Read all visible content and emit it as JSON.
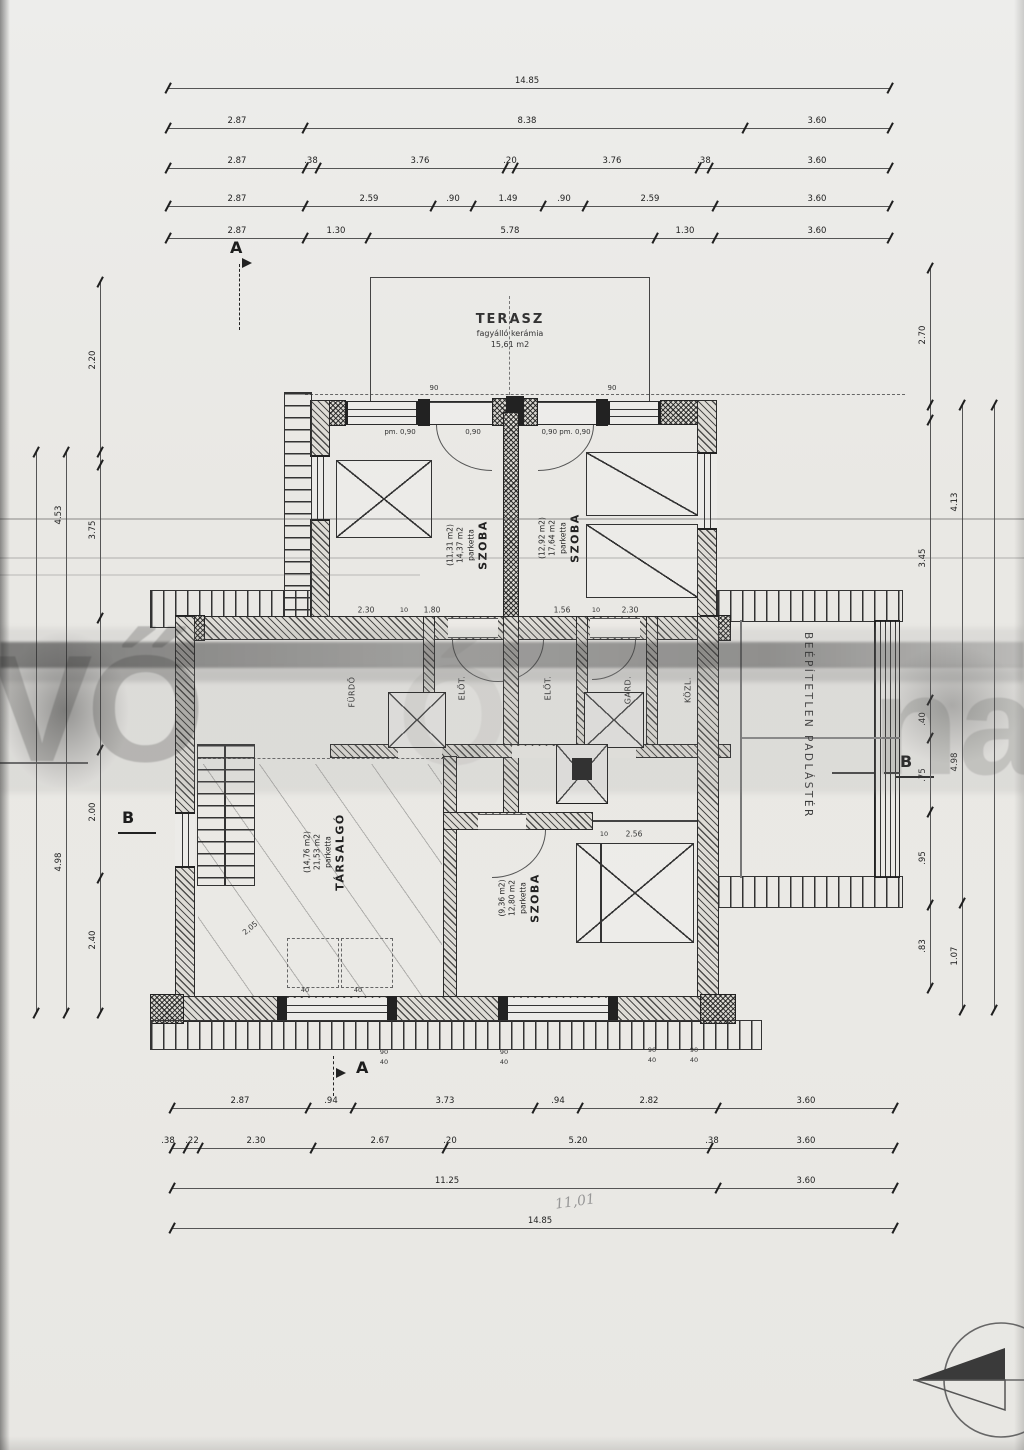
{
  "terrace": {
    "title": "TERASZ",
    "sub1": "fagyálló kerámia",
    "sub2": "15,61 m2"
  },
  "attic_label": "BEÉPÍTETLEN PADLÁSTÉR",
  "markers": {
    "a": "A",
    "b": "B"
  },
  "watermark": {
    "left": "IVŐ",
    "mid": "Ó",
    "right": "nal"
  },
  "rooms": {
    "bedroom_left": {
      "lines": [
        "SZOBA",
        "parketta",
        "14,37 m2",
        "(11,31 m2)"
      ]
    },
    "bedroom_right": {
      "lines": [
        "SZOBA",
        "parketta",
        "17,64 m2",
        "(12,92 m2)"
      ]
    },
    "lounge": {
      "lines": [
        "TÁRSALGÓ",
        "parketta",
        "21,53 m2",
        "(14,76 m2)"
      ]
    },
    "bedroom_down": {
      "lines": [
        "SZOBA",
        "parketta",
        "12,80 m2",
        "(9,36 m2)"
      ]
    }
  },
  "annotations": [
    {
      "t": "pm. 0,90",
      "x": 400,
      "y": 432,
      "fs": 7
    },
    {
      "t": "0,90",
      "x": 473,
      "y": 432,
      "fs": 7
    },
    {
      "t": "0,90  pm. 0,90",
      "x": 566,
      "y": 432,
      "fs": 7
    },
    {
      "t": "90",
      "x": 434,
      "y": 388,
      "fs": 7
    },
    {
      "t": "90",
      "x": 612,
      "y": 388,
      "fs": 7
    },
    {
      "t": "2.30",
      "x": 366,
      "y": 610,
      "fs": 7.5
    },
    {
      "t": "10",
      "x": 404,
      "y": 610,
      "fs": 6.5
    },
    {
      "t": "1.80",
      "x": 432,
      "y": 610,
      "fs": 7.5
    },
    {
      "t": "1.56",
      "x": 562,
      "y": 610,
      "fs": 7.5
    },
    {
      "t": "10",
      "x": 596,
      "y": 610,
      "fs": 6.5
    },
    {
      "t": "2.30",
      "x": 630,
      "y": 610,
      "fs": 7.5
    },
    {
      "t": "10",
      "x": 604,
      "y": 834,
      "fs": 6.5
    },
    {
      "t": "2.56",
      "x": 634,
      "y": 834,
      "fs": 7.5
    },
    {
      "t": "90",
      "x": 384,
      "y": 1052,
      "fs": 6.5
    },
    {
      "t": "40",
      "x": 384,
      "y": 1062,
      "fs": 6.5
    },
    {
      "t": "90",
      "x": 504,
      "y": 1052,
      "fs": 6.5
    },
    {
      "t": "40",
      "x": 504,
      "y": 1062,
      "fs": 6.5
    },
    {
      "t": "90",
      "x": 652,
      "y": 1050,
      "fs": 6.5
    },
    {
      "t": "40",
      "x": 652,
      "y": 1060,
      "fs": 6.5
    },
    {
      "t": "90",
      "x": 694,
      "y": 1050,
      "fs": 6.5
    },
    {
      "t": "40",
      "x": 694,
      "y": 1060,
      "fs": 6.5
    },
    {
      "t": "2,05",
      "x": 250,
      "y": 928,
      "r": -40,
      "fs": 7.5
    },
    {
      "t": "40",
      "x": 305,
      "y": 990,
      "fs": 6.5
    },
    {
      "t": "40",
      "x": 358,
      "y": 990,
      "fs": 6.5
    },
    {
      "t": "11,01",
      "x": 575,
      "y": 1202,
      "r": -8,
      "cls": "hand"
    },
    {
      "t": "FÜRDŐ",
      "x": 352,
      "y": 692,
      "r": -90,
      "cls": "room-s"
    },
    {
      "t": "ELŐT.",
      "x": 462,
      "y": 688,
      "r": -90,
      "cls": "room-s"
    },
    {
      "t": "ELŐT.",
      "x": 548,
      "y": 688,
      "r": -90,
      "cls": "room-s"
    },
    {
      "t": "GARD.",
      "x": 628,
      "y": 690,
      "r": -90,
      "cls": "room-s"
    },
    {
      "t": "KÖZL.",
      "x": 688,
      "y": 690,
      "r": -90,
      "cls": "room-s"
    }
  ],
  "dim_chains": {
    "h": [
      {
        "y": 88,
        "x1": 168,
        "x2": 890,
        "ticks": [
          168,
          890
        ],
        "labels": [
          {
            "t": "14.85",
            "x": 527
          }
        ]
      },
      {
        "y": 128,
        "x1": 168,
        "x2": 890,
        "ticks": [
          168,
          305,
          745,
          890
        ],
        "labels": [
          {
            "t": "2.87",
            "x": 237
          },
          {
            "t": "8.38",
            "x": 527
          },
          {
            "t": "3.60",
            "x": 817
          }
        ]
      },
      {
        "y": 168,
        "x1": 168,
        "x2": 890,
        "ticks": [
          168,
          305,
          318,
          505,
          515,
          698,
          710,
          890
        ],
        "labels": [
          {
            "t": "2.87",
            "x": 237
          },
          {
            "t": ".38",
            "x": 311
          },
          {
            "t": "3.76",
            "x": 420
          },
          {
            "t": ".20",
            "x": 510
          },
          {
            "t": "3.76",
            "x": 612
          },
          {
            "t": ".38",
            "x": 704
          },
          {
            "t": "3.60",
            "x": 817
          }
        ]
      },
      {
        "y": 206,
        "x1": 168,
        "x2": 890,
        "ticks": [
          168,
          305,
          433,
          473,
          543,
          585,
          715,
          890
        ],
        "labels": [
          {
            "t": "2.87",
            "x": 237
          },
          {
            "t": "2.59",
            "x": 369
          },
          {
            "t": ".90",
            "x": 453
          },
          {
            "t": "1.49",
            "x": 508
          },
          {
            "t": ".90",
            "x": 564
          },
          {
            "t": "2.59",
            "x": 650
          },
          {
            "t": "3.60",
            "x": 817
          }
        ]
      },
      {
        "y": 238,
        "x1": 168,
        "x2": 890,
        "ticks": [
          168,
          305,
          368,
          655,
          715,
          890
        ],
        "labels": [
          {
            "t": "2.87",
            "x": 237
          },
          {
            "t": "1.30",
            "x": 336
          },
          {
            "t": "5.78",
            "x": 510
          },
          {
            "t": "1.30",
            "x": 685
          },
          {
            "t": "3.60",
            "x": 817
          }
        ]
      },
      {
        "y": 1108,
        "x1": 172,
        "x2": 895,
        "ticks": [
          172,
          308,
          353,
          535,
          580,
          718,
          895
        ],
        "labels": [
          {
            "t": "2.87",
            "x": 240
          },
          {
            "t": ".94",
            "x": 331
          },
          {
            "t": "3.73",
            "x": 445
          },
          {
            "t": ".94",
            "x": 558
          },
          {
            "t": "2.82",
            "x": 649
          },
          {
            "t": "3.60",
            "x": 806
          }
        ]
      },
      {
        "y": 1148,
        "x1": 172,
        "x2": 895,
        "ticks": [
          172,
          186,
          200,
          313,
          445,
          710,
          895
        ],
        "labels": [
          {
            "t": ".38",
            "x": 168
          },
          {
            "t": ".22",
            "x": 192
          },
          {
            "t": "2.30",
            "x": 256
          },
          {
            "t": "2.67",
            "x": 380
          },
          {
            "t": ".20",
            "x": 450
          },
          {
            "t": "5.20",
            "x": 578
          },
          {
            "t": ".38",
            "x": 712
          },
          {
            "t": "3.60",
            "x": 806
          }
        ]
      },
      {
        "y": 1188,
        "x1": 172,
        "x2": 895,
        "ticks": [
          172,
          718,
          895
        ],
        "labels": [
          {
            "t": "11.25",
            "x": 447
          },
          {
            "t": "3.60",
            "x": 806
          }
        ]
      },
      {
        "y": 1228,
        "x1": 172,
        "x2": 895,
        "ticks": [
          172,
          895
        ],
        "labels": [
          {
            "t": "14.85",
            "x": 540
          }
        ]
      }
    ],
    "v": [
      {
        "x": 100,
        "y1": 282,
        "y2": 1013,
        "ticks": [
          282,
          452,
          465,
          618,
          750,
          878,
          1013
        ],
        "labels": [
          {
            "t": "2.20",
            "y": 360
          },
          {
            "t": "3.75",
            "y": 530
          },
          {
            "t": "2.00",
            "y": 812
          },
          {
            "t": "2.40",
            "y": 940
          }
        ]
      },
      {
        "x": 66,
        "y1": 452,
        "y2": 1013,
        "ticks": [
          452,
          1013
        ],
        "labels": [
          {
            "t": "4.53",
            "y": 515
          },
          {
            "t": "4.98",
            "y": 862
          }
        ]
      },
      {
        "x": 36,
        "y1": 452,
        "y2": 1013,
        "ticks": [
          452,
          1013
        ],
        "labels": []
      },
      {
        "x": 930,
        "y1": 268,
        "y2": 988,
        "ticks": [
          268,
          405,
          420,
          700,
          738,
          812,
          905,
          988
        ],
        "labels": [
          {
            "t": "2.70",
            "y": 335
          },
          {
            "t": "3.45",
            "y": 558
          },
          {
            "t": ".40",
            "y": 719
          },
          {
            "t": ".75",
            "y": 775
          },
          {
            "t": ".95",
            "y": 858
          },
          {
            "t": ".83",
            "y": 946
          }
        ]
      },
      {
        "x": 962,
        "y1": 405,
        "y2": 1010,
        "ticks": [
          405,
          903,
          1010
        ],
        "labels": [
          {
            "t": "4.13",
            "y": 502
          },
          {
            "t": "4.98",
            "y": 762
          },
          {
            "t": "1.07",
            "y": 956
          }
        ]
      },
      {
        "x": 994,
        "y1": 405,
        "y2": 1010,
        "ticks": [
          405,
          1010
        ],
        "labels": []
      }
    ]
  }
}
